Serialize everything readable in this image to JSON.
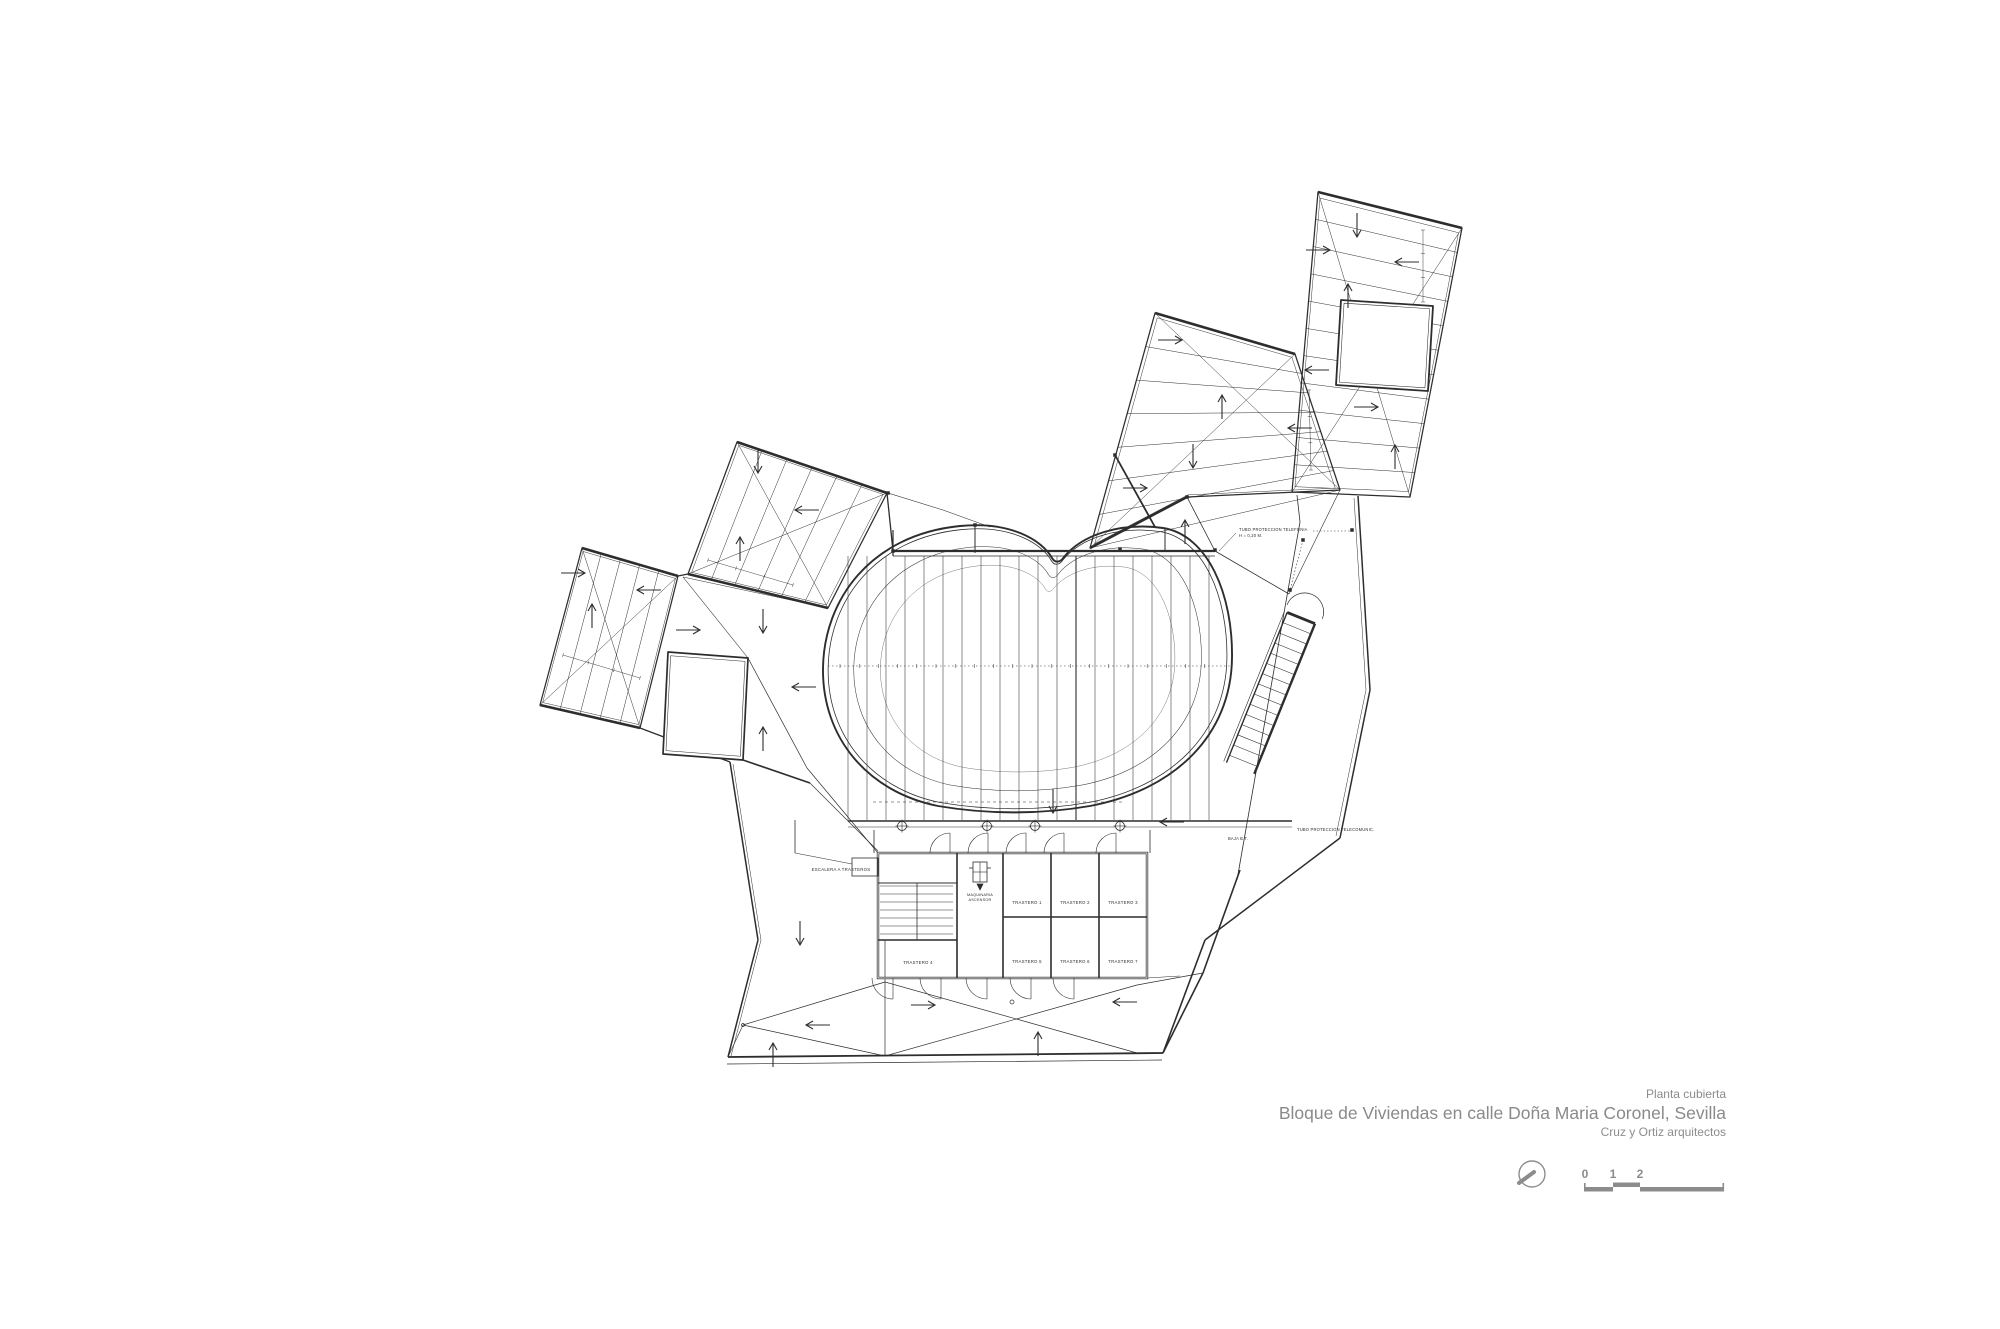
{
  "page": {
    "background": "#ffffff"
  },
  "title_block": {
    "kicker": "Planta cubierta",
    "title": "Bloque de Viviendas en calle Doña Maria Coronel, Sevilla",
    "firm": "Cruz y Ortiz arquitectos"
  },
  "scale_bar": {
    "ticks": [
      "0",
      "1",
      "2",
      "5"
    ]
  },
  "north_indicator": {
    "icon": "north-compass-icon"
  },
  "plan": {
    "rooms": {
      "trastero1": "TRASTERO 1",
      "trastero2": "TRASTERO 2",
      "trastero3": "TRASTERO 3",
      "trastero4": "TRASTERO 4",
      "trastero5": "TRASTERO 5",
      "trastero6": "TRASTERO 6",
      "trastero7": "TRASTERO 7",
      "machine_room_line1": "MAQUINARIA",
      "machine_room_line2": "ASCENSOR"
    },
    "annotations": {
      "stair_label": "ESCALERA A TRASTEROS",
      "tubo_telefonia_line1": "TUBO PROTECCION TELEFONIA",
      "tubo_telefonia_line2": "H = 0,20 M.",
      "tubo_telecom": "TUBO PROTECCION TELECOMUNIC.",
      "baja_bt": "BAJA B.T."
    }
  },
  "colors": {
    "ink": "#2d2d2d",
    "muted_text": "#8c8c8c"
  }
}
